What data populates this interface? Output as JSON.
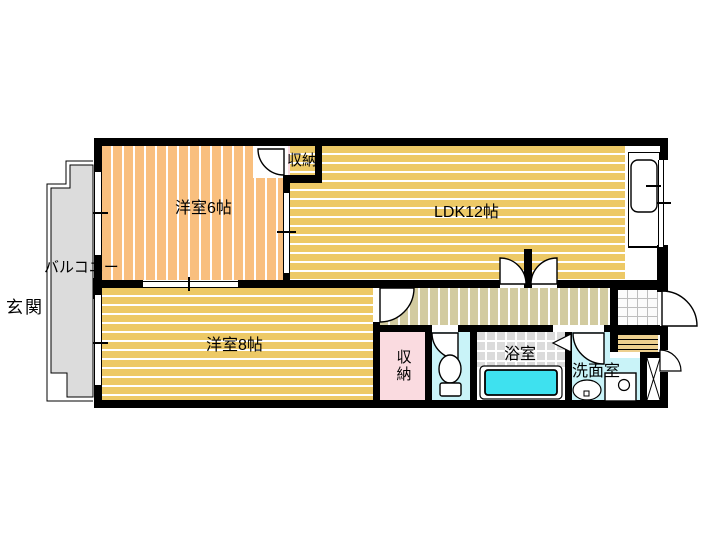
{
  "floor_plan": {
    "labels": {
      "balcony": "バルコニー",
      "entrance": "玄関",
      "western_room_6": "洋室6帖",
      "ldk": "LDK12帖",
      "closet_upper": "収納",
      "western_room_8": "洋室8帖",
      "closet_lower": "収納",
      "bathroom": "浴室",
      "washroom": "洗面室"
    },
    "colors": {
      "wall": "#000000",
      "western_room_floor": "#F9BF7E",
      "ldk_floor": "#EDC966",
      "hallway_floor": "#D2CBA0",
      "closet": "#FADBE0",
      "wet_room": "#C9F3F8",
      "bathtub": "#3EE1EF",
      "tile": "#DBDBDB",
      "balcony": "#DCDCDC",
      "steps": "#EDD08F"
    }
  }
}
